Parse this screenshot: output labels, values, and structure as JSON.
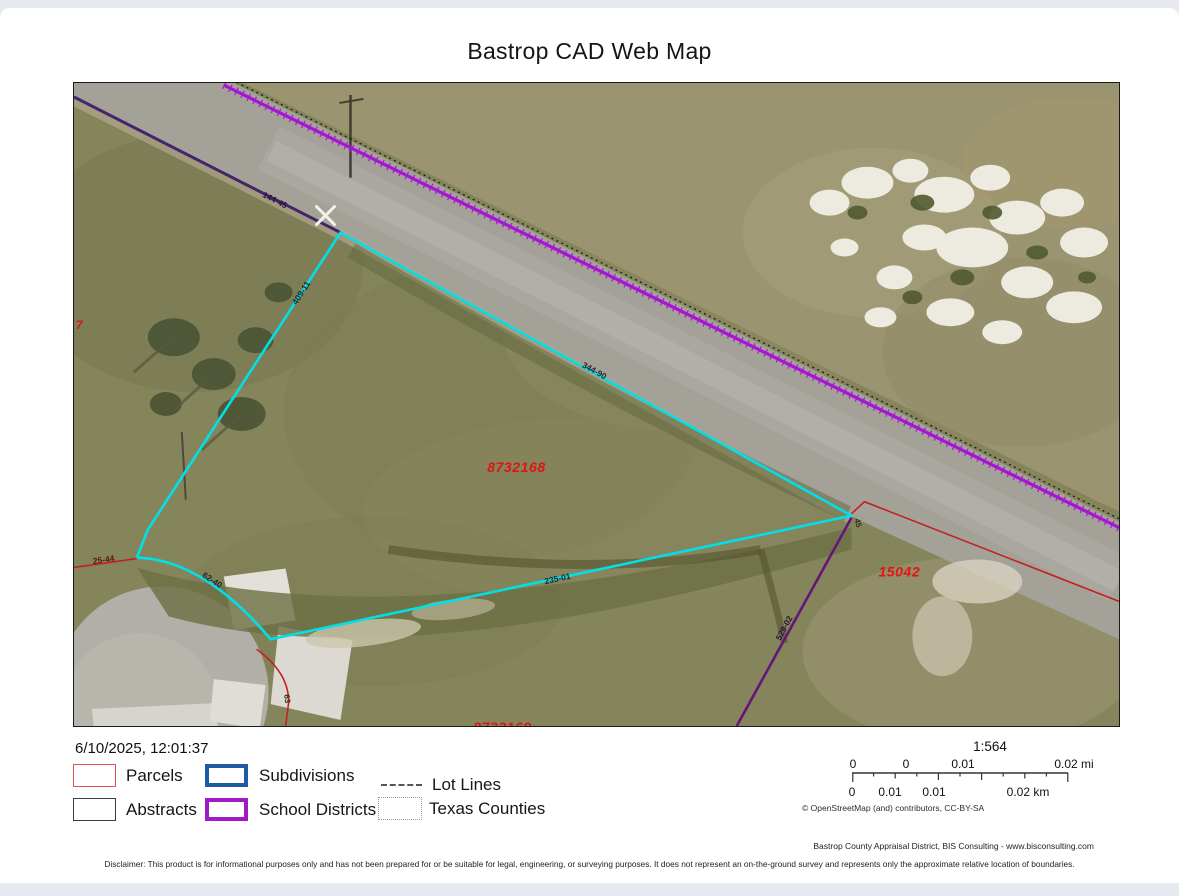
{
  "page": {
    "title": "Bastrop CAD Web Map"
  },
  "export": {
    "timestamp": "6/10/2025, 12:01:37",
    "scale_ratio": "1:564",
    "scale_mi_labels": [
      "0",
      "0",
      "0.01",
      "0.02 mi"
    ],
    "scale_km_labels": [
      "0",
      "0.01",
      "0.01",
      "0.02 km"
    ],
    "attribution": "© OpenStreetMap (and) contributors, CC-BY-SA",
    "credit": "Bastrop County Appraisal District, BIS Consulting - www.bisconsulting.com",
    "disclaimer": "Disclaimer: This product is for informational purposes only and has not been prepared for or be suitable for legal, engineering, or surveying purposes. It does not represent an on-the-ground survey and represents only the approximate relative location of boundaries."
  },
  "legend": {
    "items": [
      {
        "label": "Parcels",
        "swatch": "box-thin-red",
        "color": "#d9534f"
      },
      {
        "label": "Subdivisions",
        "swatch": "box-thick-blue",
        "color": "#1d5ca4"
      },
      {
        "label": "Lot Lines",
        "swatch": "dashed-line",
        "color": "#555555"
      },
      {
        "label": "Abstracts",
        "swatch": "box-thin-dark",
        "color": "#3c3c3c"
      },
      {
        "label": "School Districts",
        "swatch": "box-thick-purple",
        "color": "#a21ac4"
      },
      {
        "label": "Texas Counties",
        "swatch": "dotted-box",
        "color": "#9a9a9a"
      }
    ]
  },
  "map": {
    "parcel_ids": {
      "main": "8732168",
      "east": "15042",
      "south_clipped": "8732169",
      "west_clipped": "7"
    },
    "dimensions": {
      "road_nw": "144-45",
      "west_boundary": "409-11",
      "road_se": "344-90",
      "south_boundary": "235-01",
      "culdesac": "62-40",
      "west_line": "25-44",
      "east_vertex": "45",
      "southeast_line": "529-02",
      "arc_south": "63"
    },
    "colors": {
      "parcel_boundary": "#00e0e6",
      "school_district": "#a714d4",
      "district_nw": "#43256e",
      "parcel_line": "#c42020",
      "parcel_id_text": "#e01414"
    }
  }
}
